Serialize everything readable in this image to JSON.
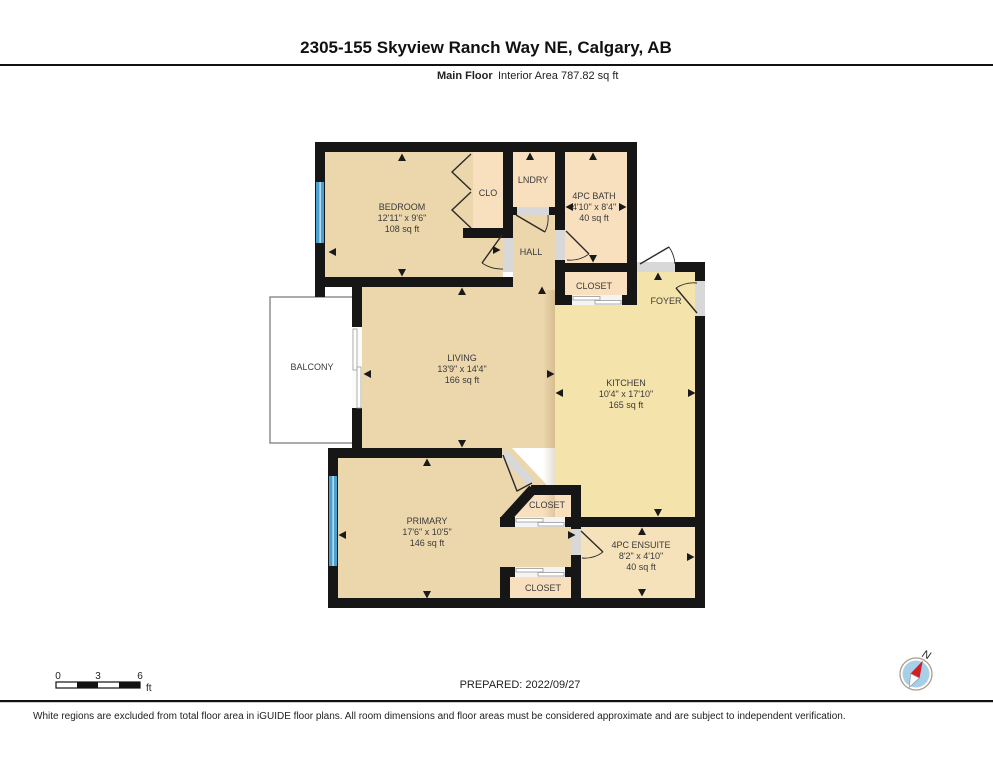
{
  "header": {
    "title": "2305-155 Skyview Ranch Way NE, Calgary, AB",
    "floor_label": "Main Floor",
    "area_label": "Interior Area 787.82 sq ft"
  },
  "rooms": {
    "bedroom": {
      "name": "BEDROOM",
      "dims": "12'11\" x 9'6\"",
      "area": "108 sq ft"
    },
    "clo": {
      "name": "CLO"
    },
    "lndry": {
      "name": "LNDRY"
    },
    "bath": {
      "name": "4PC BATH",
      "dims": "4'10\" x 8'4\"",
      "area": "40 sq ft"
    },
    "hall": {
      "name": "HALL"
    },
    "closet_top": {
      "name": "CLOSET"
    },
    "foyer": {
      "name": "FOYER"
    },
    "balcony": {
      "name": "BALCONY"
    },
    "living": {
      "name": "LIVING",
      "dims": "13'9\" x 14'4\"",
      "area": "166 sq ft"
    },
    "kitchen": {
      "name": "KITCHEN",
      "dims": "10'4\" x 17'10\"",
      "area": "165 sq ft"
    },
    "primary": {
      "name": "PRIMARY",
      "dims": "17'6\" x 10'5\"",
      "area": "146 sq ft"
    },
    "closet_mid": {
      "name": "CLOSET"
    },
    "ensuite": {
      "name": "4PC ENSUITE",
      "dims": "8'2\" x 4'10\"",
      "area": "40 sq ft"
    },
    "closet_bot": {
      "name": "CLOSET"
    }
  },
  "footer": {
    "scale": {
      "tick0": "0",
      "tick1": "3",
      "tick2": "6",
      "unit": "ft"
    },
    "prepared": "PREPARED: 2022/09/27",
    "compass_label": "N",
    "disclaimer": "White regions are excluded from total floor area in iGUIDE floor plans. All room dimensions and floor areas must be considered approximate and are subject to independent verification."
  },
  "colors": {
    "wall": "#161616",
    "tan": "#ecd6ac",
    "peach": "#f8e0bf",
    "yellow": "#f5e3ac",
    "ensuite_fill": "#f6e2ba",
    "door_opening": "#d8d8d8",
    "slide_opening": "#f4f4f4",
    "window_blue": "#4aa0cf",
    "compass_disc": "#a8cfe8",
    "compass_red": "#cf2027"
  }
}
